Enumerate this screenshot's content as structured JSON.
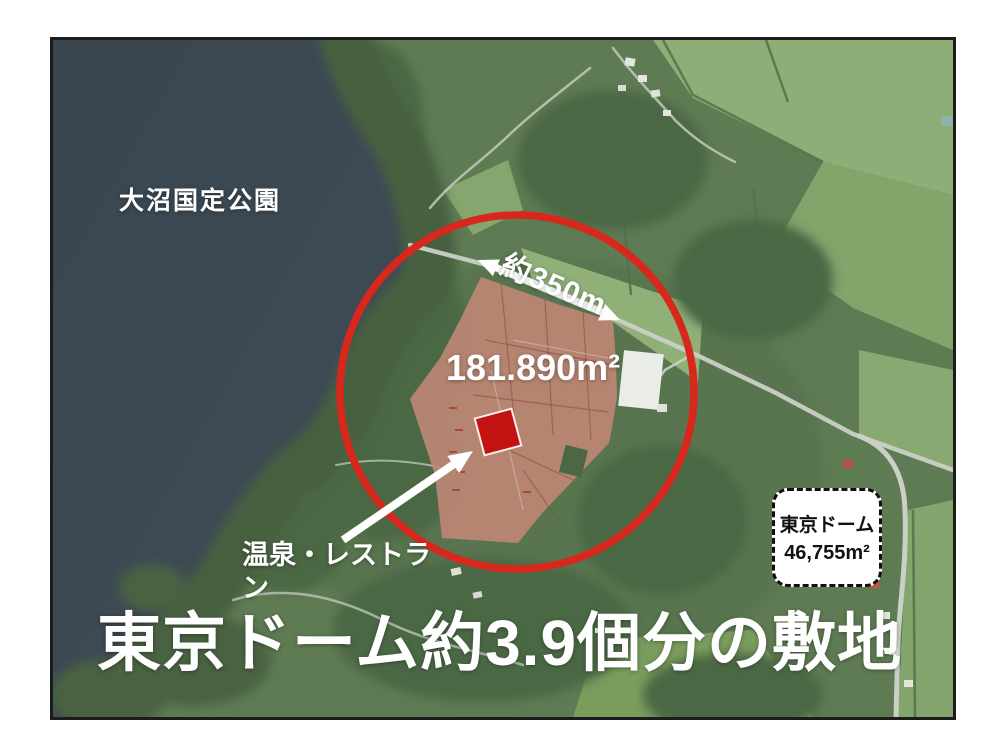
{
  "page": {
    "background": "#ffffff"
  },
  "map": {
    "park_label": "大沼国定公園",
    "distance_label": "約350m",
    "area_label": "181.890m²",
    "facility_label": {
      "lines": [
        "温泉・レストラ",
        "ン"
      ]
    },
    "dome_box": {
      "title": "東京ドーム",
      "area": "46,755m²"
    },
    "caption": "東京ドーム約3.9個分の敷地",
    "colors": {
      "highlight_circle": "#d8271c",
      "site_overlay": "#c28877",
      "marker": "#c31212",
      "lake": "#3c4952",
      "land": "#5e7b53",
      "annotation_text": "#ffffff",
      "dome_box_border": "#111111"
    }
  }
}
